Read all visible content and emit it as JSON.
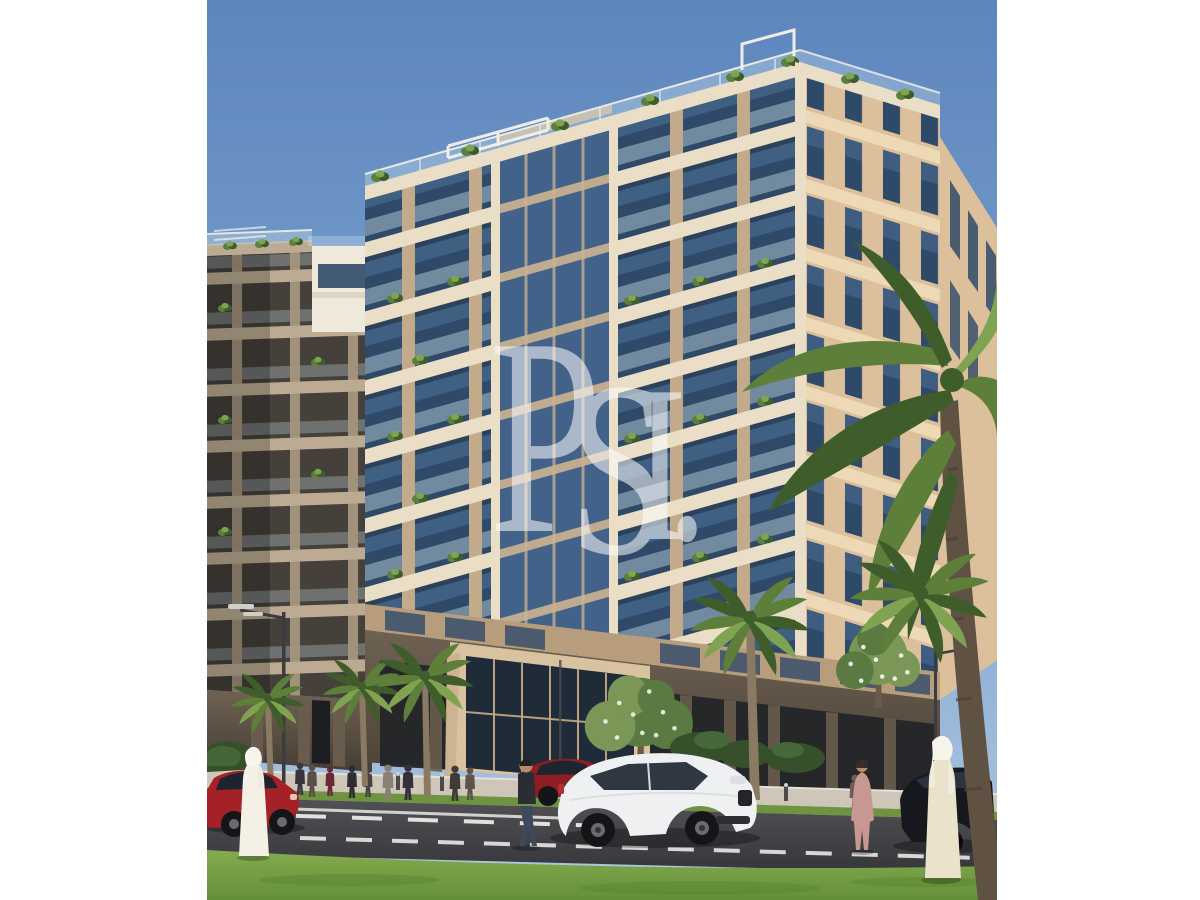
{
  "canvas": {
    "background": "#ffffff",
    "width": 1200,
    "height": 900
  },
  "photo": {
    "left": 207,
    "top": 0,
    "width": 790,
    "height": 900,
    "type": "architectural-rendering-of-residential-building"
  },
  "watermark": {
    "text": "PSI.",
    "letters": [
      "P",
      "S",
      "I",
      "."
    ],
    "color": "#ffffff",
    "opacity": 0.55
  },
  "scene": {
    "buildings": {
      "main_floors_visible": 8,
      "facade": "beige stone with glass balconies and planted terraces"
    },
    "vehicles": [
      "red-sedan",
      "red-hatchback",
      "white-suv",
      "dark-suv"
    ],
    "pedestrians": [
      "man-in-white-kandura-left",
      "man-in-white-kandura-right",
      "woman-in-pink",
      "man-walking-center",
      "sidewalk-groups"
    ],
    "vegetation": [
      "palm-trees",
      "flowering-trees",
      "hedges",
      "front-lawn"
    ]
  },
  "palette": {
    "canvas_bg": "#ffffff",
    "sky_top": "#5d86bd",
    "sky_mid": "#7da3cf",
    "sky_low": "#b2c9e2",
    "stone_light": "#eadfc6",
    "stone_mid": "#cdb391",
    "stone_deep": "#b79d7c",
    "left_base": "#c2aa8a",
    "right_base": "#dcbf9b",
    "right_slab": "#eed9b6",
    "glass_dark": "#2f4a68",
    "glass_mid": "#4d7099",
    "rail_glass": "#cfe2ee",
    "curtain_glass": "#42628a",
    "lb_face": "#a3927b",
    "lb_slab": "#bcab92",
    "lb_dark": "#45403a",
    "penthouse": "#efe9dc",
    "ground_top": "#6f6253",
    "ground_bot": "#453d33",
    "storefront": "#232528",
    "fin": "#6a5d4e",
    "entrance_stone": "#d9c2a0",
    "entrance_glass": "#1f2b38",
    "mullion": "#c8ab85",
    "palm_dark": "#3f5d2b",
    "palm_mid": "#5d7f3a",
    "palm_light": "#7fa351",
    "trunk": "#8a7a64",
    "big_trunk": "#5f5243",
    "tree_green": "#5a7a42",
    "tree_light": "#7a9758",
    "blossom": "#eef3e8",
    "bush_dark": "#35502a",
    "lawn_light": "#85ab4e",
    "lawn_dark": "#648f39",
    "verge": "#6f9440",
    "sidewalk": "#cdc6b9",
    "curb": "#e6e1d6",
    "road_top": "#515156",
    "road_bot": "#36363a",
    "lane": "#f2f2ee",
    "car_red": "#a32127",
    "hatch_red": "#8c1e24",
    "suv_white": "#eef0f1",
    "suv_window": "#232c38",
    "car_dark": "#17181d",
    "wheel_dark": "#151518",
    "hub": "#6a6a70",
    "skin": "#b98a68",
    "kandura_white": "#f4f0e5",
    "kandura_cream": "#ebe2cb",
    "ghutra": "#f7f4ec",
    "pink_dress": "#c89791",
    "pole": "#3b3b40",
    "lamp": "#cfcfc8",
    "metal": "#4c4a46",
    "white_trim": "#f4f1e8"
  }
}
